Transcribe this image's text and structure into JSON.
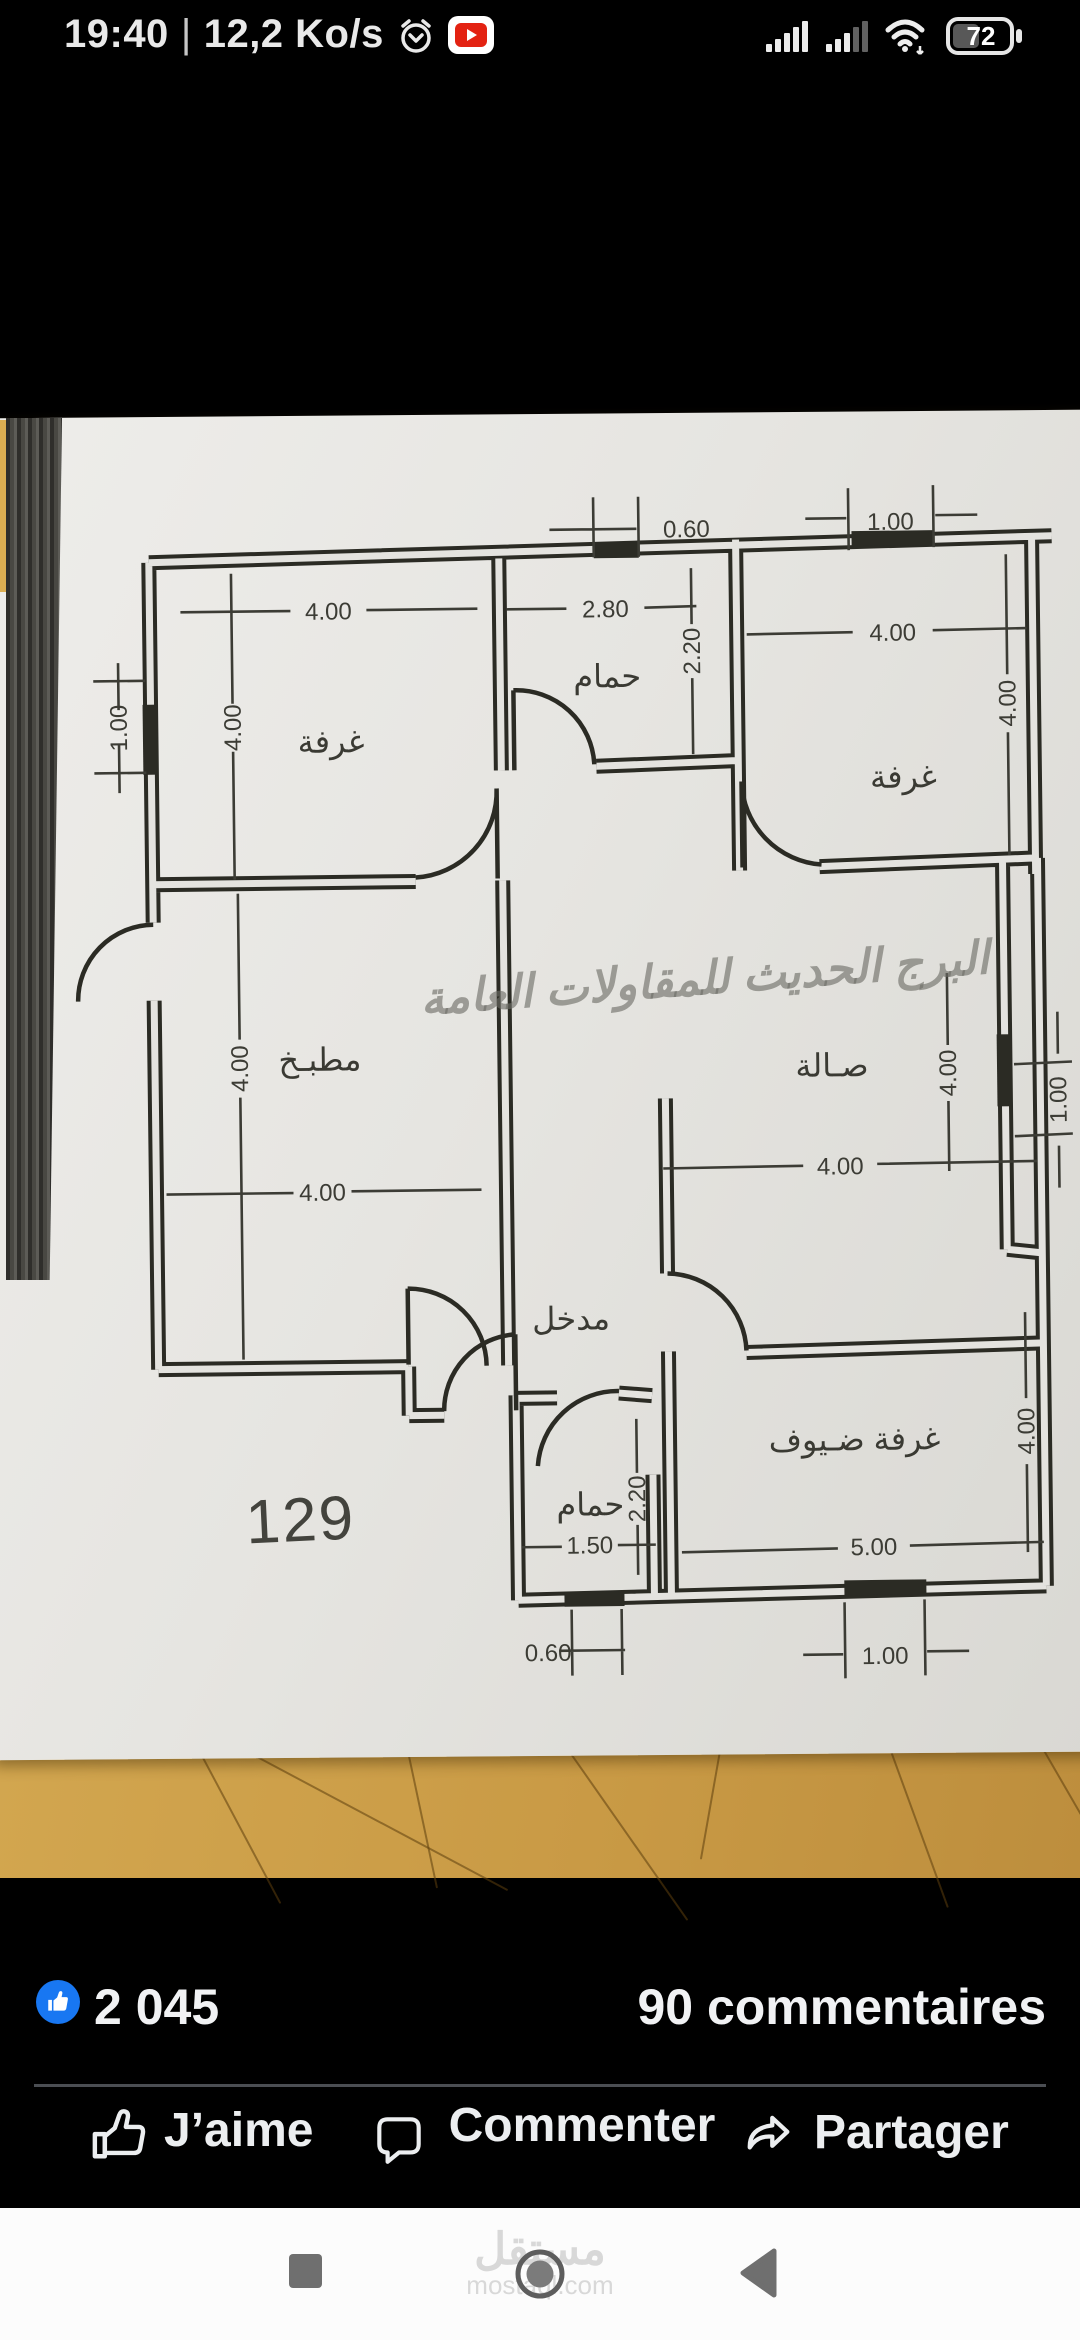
{
  "status_bar": {
    "time": "19:40",
    "separator": "|",
    "network_speed": "12,2 Ko/s",
    "battery_percent": "72"
  },
  "plan": {
    "watermark": "البرج الحديث للمقاولات العامة",
    "sheet_number": "129",
    "rooms": {
      "room_top_left": "غرفة",
      "bath_top": "حمام",
      "room_top_right": "غرفة",
      "kitchen": "مطبـخ",
      "hall": "صـالة",
      "entrance": "مدخل",
      "guest_room": "غرفة ضـيوف",
      "bath_bottom": "حمام"
    },
    "dims": {
      "top_window": "0.60",
      "top_window_right": "1.00",
      "room_tl_width": "4.00",
      "bath_top_width": "2.80",
      "room_tr_width": "4.00",
      "left_window": "1.00",
      "room_tl_height": "4.00",
      "bath_top_height": "2.20",
      "room_tr_height": "4.00",
      "kitchen_height": "4.00",
      "kitchen_width": "4.00",
      "hall_width": "4.00",
      "hall_height": "4.00",
      "right_window": "1.00",
      "guest_height": "4.00",
      "guest_width": "5.00",
      "bath_bottom_width": "1.50",
      "bath_bottom_height": "2.20",
      "bottom_window": "0.60",
      "bottom_window_right": "1.00"
    }
  },
  "post": {
    "reaction_count": "2 045",
    "comments_count": "90 commentaires",
    "like_label": "J’aime",
    "comment_label": "Commenter",
    "share_label": "Partager"
  },
  "nav": {
    "watermark_arabic": "مستقل",
    "watermark_domain": "mostaql.com"
  },
  "colors": {
    "facebook_blue": "#1877f2",
    "paper": "#e6e5e1",
    "table_wood": "#cb9e4a"
  }
}
